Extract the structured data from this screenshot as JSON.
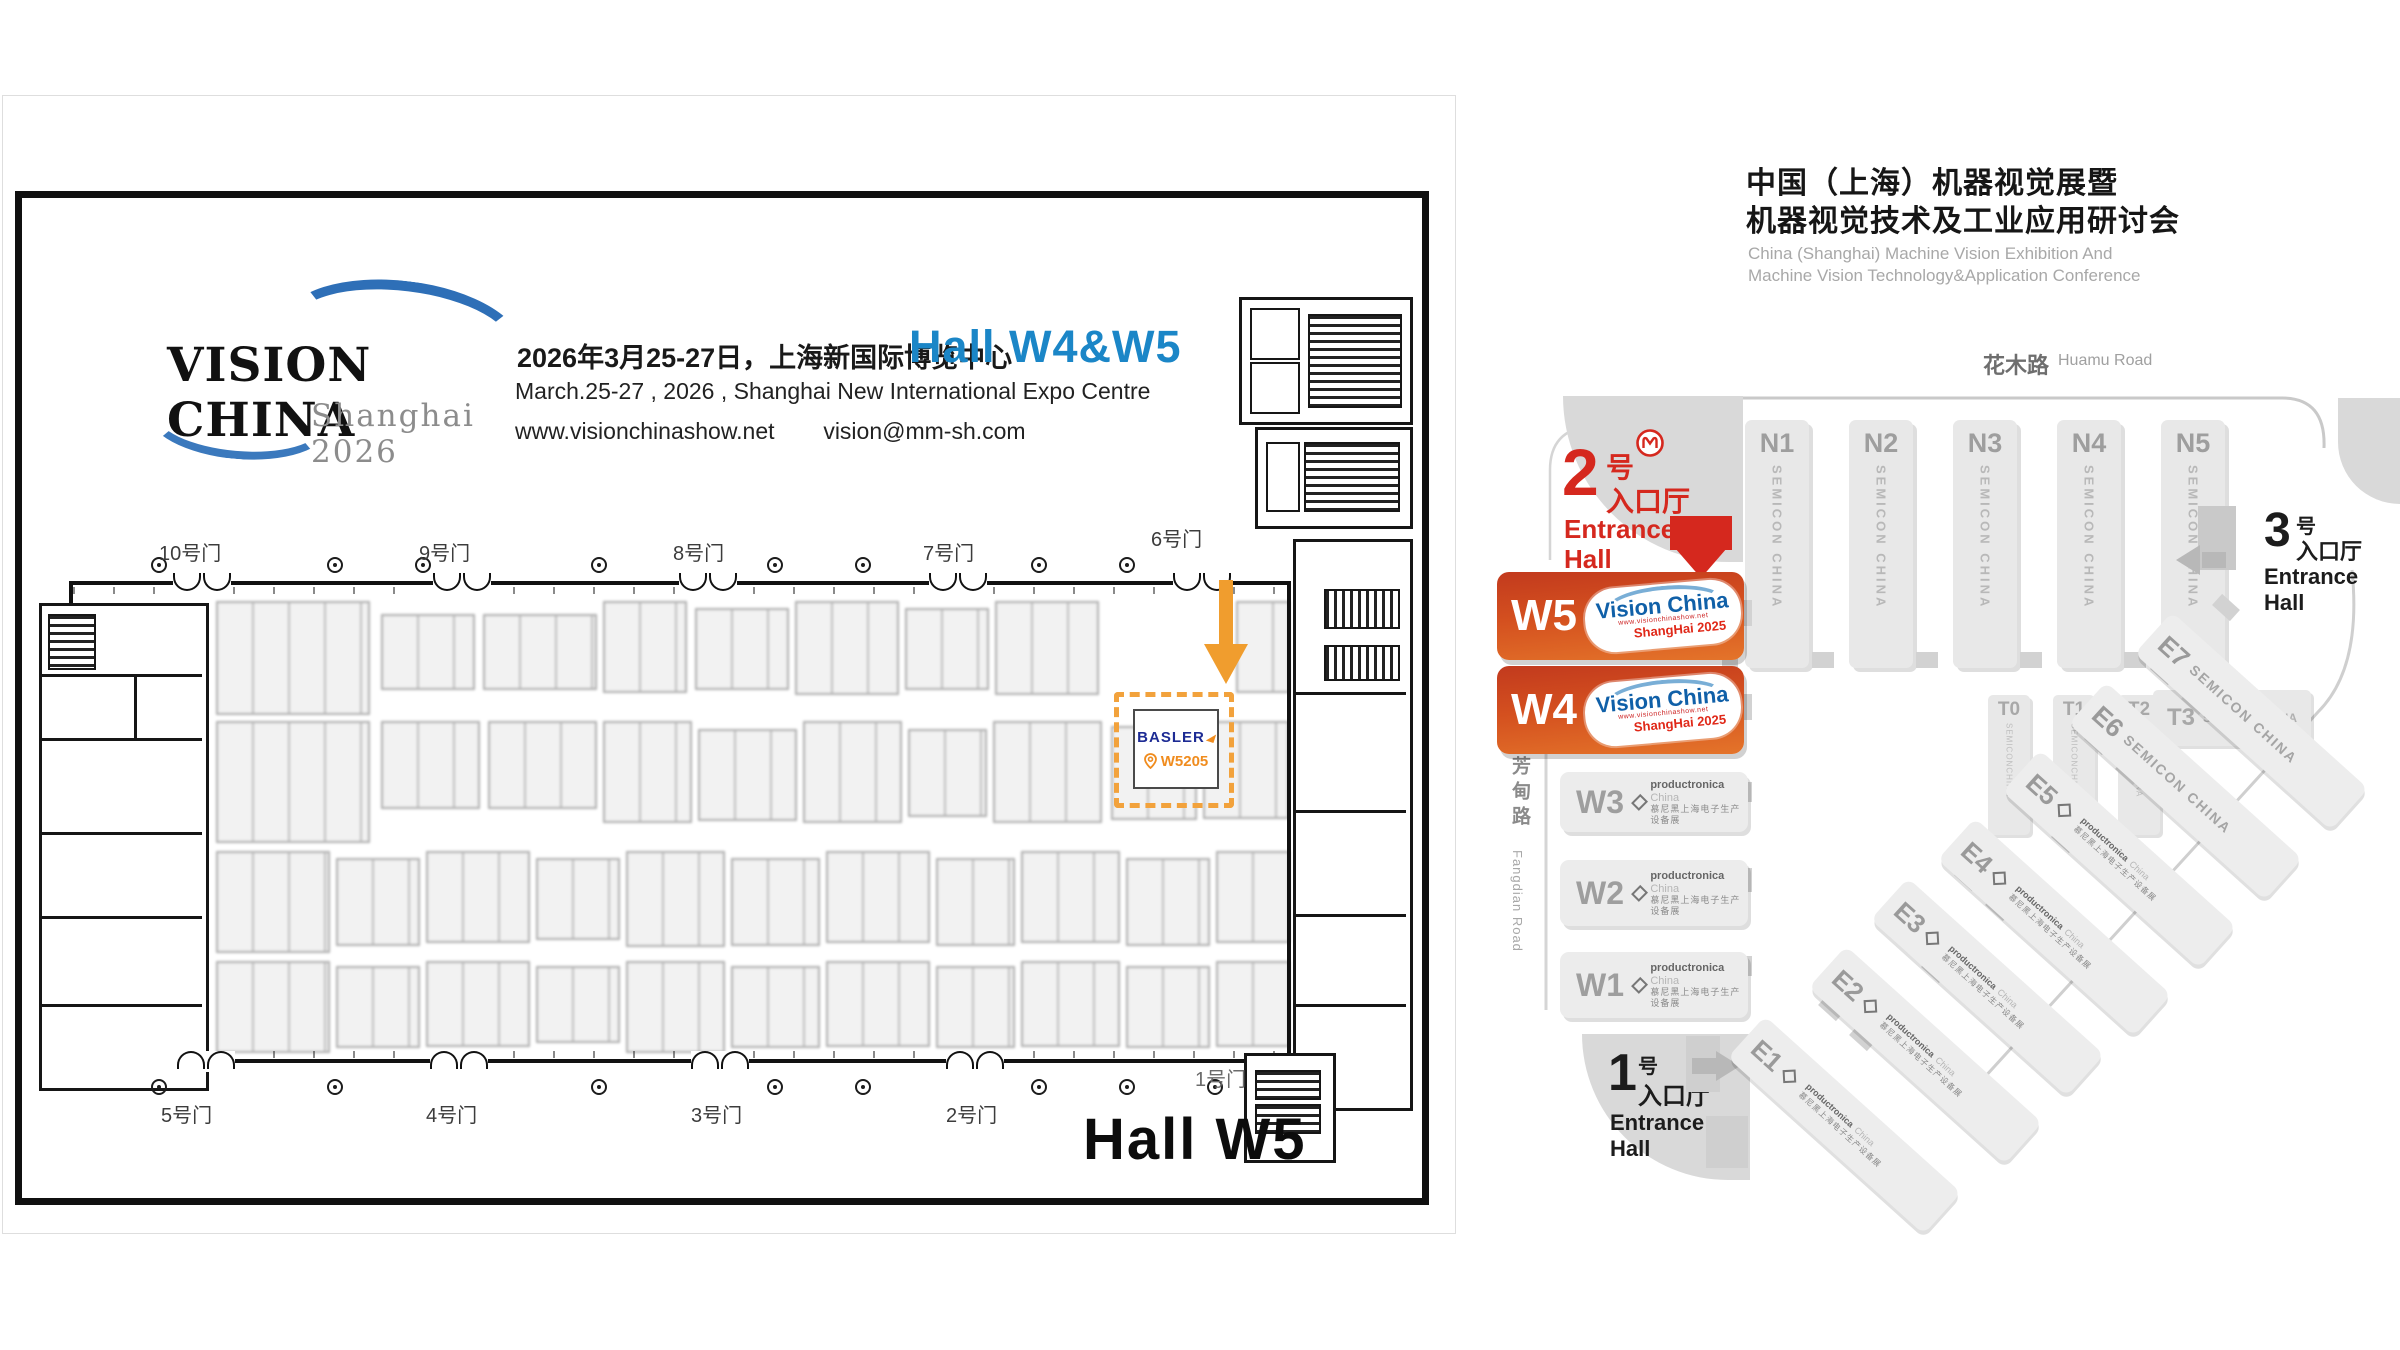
{
  "colors": {
    "accent_orange": "#F2A23C",
    "accent_red": "#D5281E",
    "accent_blue": "#1B86C7",
    "basler_blue": "#1D2B94",
    "hot_hall_gradient_top": "#C23A1E",
    "hot_hall_gradient_bottom": "#E4742A"
  },
  "left_panel": {
    "logo": {
      "title": "VISION CHINA",
      "subtitle": "Shanghai 2026"
    },
    "info": {
      "line_cn": "2026年3月25-27日，上海新国际博览中心",
      "line_en": "March.25-27 , 2026 , Shanghai New International Expo Centre",
      "website": "www.visionchinashow.net",
      "email": "vision@mm-sh.com",
      "hall_badge": "Hall W4&W5"
    },
    "gates_top": [
      "10号门",
      "9号门",
      "8号门",
      "7号门",
      "6号门"
    ],
    "gates_bottom": [
      "5号门",
      "4号门",
      "3号门",
      "2号门",
      "1号门"
    ],
    "booth": {
      "brand": "BASLER",
      "number": "W5205"
    },
    "hall_label": "Hall W5"
  },
  "right_panel": {
    "title_cn_1": "中国（上海）机器视觉展暨",
    "title_cn_2": "机器视觉技术及工业应用研讨会",
    "title_en_1": "China (Shanghai) Machine Vision Exhibition And",
    "title_en_2": "Machine Vision Technology&Application Conference",
    "roads": {
      "huamu_cn": "花木路",
      "huamu_en": "Huamu Road",
      "fangdian_cn": "芳甸路",
      "fangdian_en": "Fangdian Road",
      "longyang_cn": "龙阳路",
      "longyang_en": "Longyang Road"
    },
    "entrance2": {
      "num": "2",
      "hao": "号",
      "lobby": "入口厅",
      "en_1": "Entrance",
      "en_2": "Hall"
    },
    "entrance1": {
      "num": "1",
      "hao": "号",
      "lobby": "入口厅",
      "en_1": "Entrance",
      "en_2": "Hall"
    },
    "entrance3": {
      "num": "3",
      "hao": "号",
      "lobby": "入口厅",
      "en_1": "Entrance",
      "en_2": "Hall"
    },
    "parking": {
      "id": "P1",
      "label_cn": "停车场"
    },
    "vision_badge": {
      "brand": "Vision China",
      "url": "www.visionchinashow.net",
      "edition": "ShangHai 2025"
    },
    "productronica": {
      "brand": "productronica",
      "region": "China",
      "cn": "慕尼黑上海电子生产设备展"
    },
    "halls_n": [
      {
        "id": "N1",
        "tag": "SEMICON CHINA"
      },
      {
        "id": "N2",
        "tag": "SEMICON CHINA"
      },
      {
        "id": "N3",
        "tag": "SEMICON CHINA"
      },
      {
        "id": "N4",
        "tag": "SEMICON CHINA"
      },
      {
        "id": "N5",
        "tag": "SEMICON CHINA"
      }
    ],
    "halls_w": [
      {
        "id": "W5"
      },
      {
        "id": "W4"
      }
    ],
    "halls_w_gray": [
      {
        "id": "W3"
      },
      {
        "id": "W2"
      },
      {
        "id": "W1"
      }
    ],
    "halls_t": [
      {
        "id": "T0",
        "tag": "SEMICONCHINA"
      },
      {
        "id": "T1",
        "tag": "SEMICONCHINA"
      },
      {
        "id": "T2",
        "tag": "SEMICONCHINA"
      },
      {
        "id": "T3",
        "tag": "SEMICONCHINA"
      }
    ],
    "halls_e": [
      {
        "id": "E1",
        "type": "productronica"
      },
      {
        "id": "E2",
        "type": "productronica"
      },
      {
        "id": "E3",
        "type": "productronica"
      },
      {
        "id": "E4",
        "type": "productronica"
      },
      {
        "id": "E5",
        "type": "productronica"
      },
      {
        "id": "E6",
        "tag": "SEMICON CHINA"
      },
      {
        "id": "E7",
        "tag": "SEMICON CHINA"
      }
    ]
  }
}
